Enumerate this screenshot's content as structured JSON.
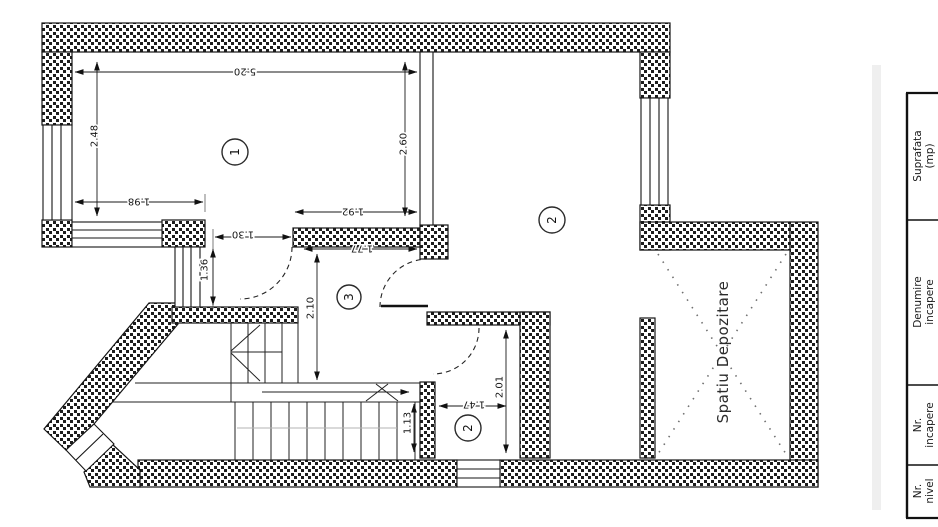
{
  "floor_plan": {
    "dims": {
      "room1_width": "5.20",
      "room1_height_left": "2.48",
      "room1_height_right": "2.60",
      "room1_seg_left": "1.98",
      "room1_seg_right": "1.92",
      "door_opening": "1.30",
      "hall_top_width": "1.77",
      "wall_stub_height": "1.36",
      "hall_height": "2.10",
      "stair_width": "1.13",
      "wc_width": "1.47",
      "wc_height": "2.01"
    },
    "rooms": {
      "room1": "1",
      "room2": "2",
      "room3": "3",
      "wc": "2"
    },
    "storage_label": "Spatiu Depozitare"
  },
  "table": {
    "columns": [
      {
        "line1": "Suprafata",
        "line2": "(mp)"
      },
      {
        "line1": "Denumire",
        "line2": "incapere"
      },
      {
        "line1": "Nr.",
        "line2": "incapere"
      },
      {
        "line1": "Nr.",
        "line2": "nivel"
      }
    ]
  }
}
